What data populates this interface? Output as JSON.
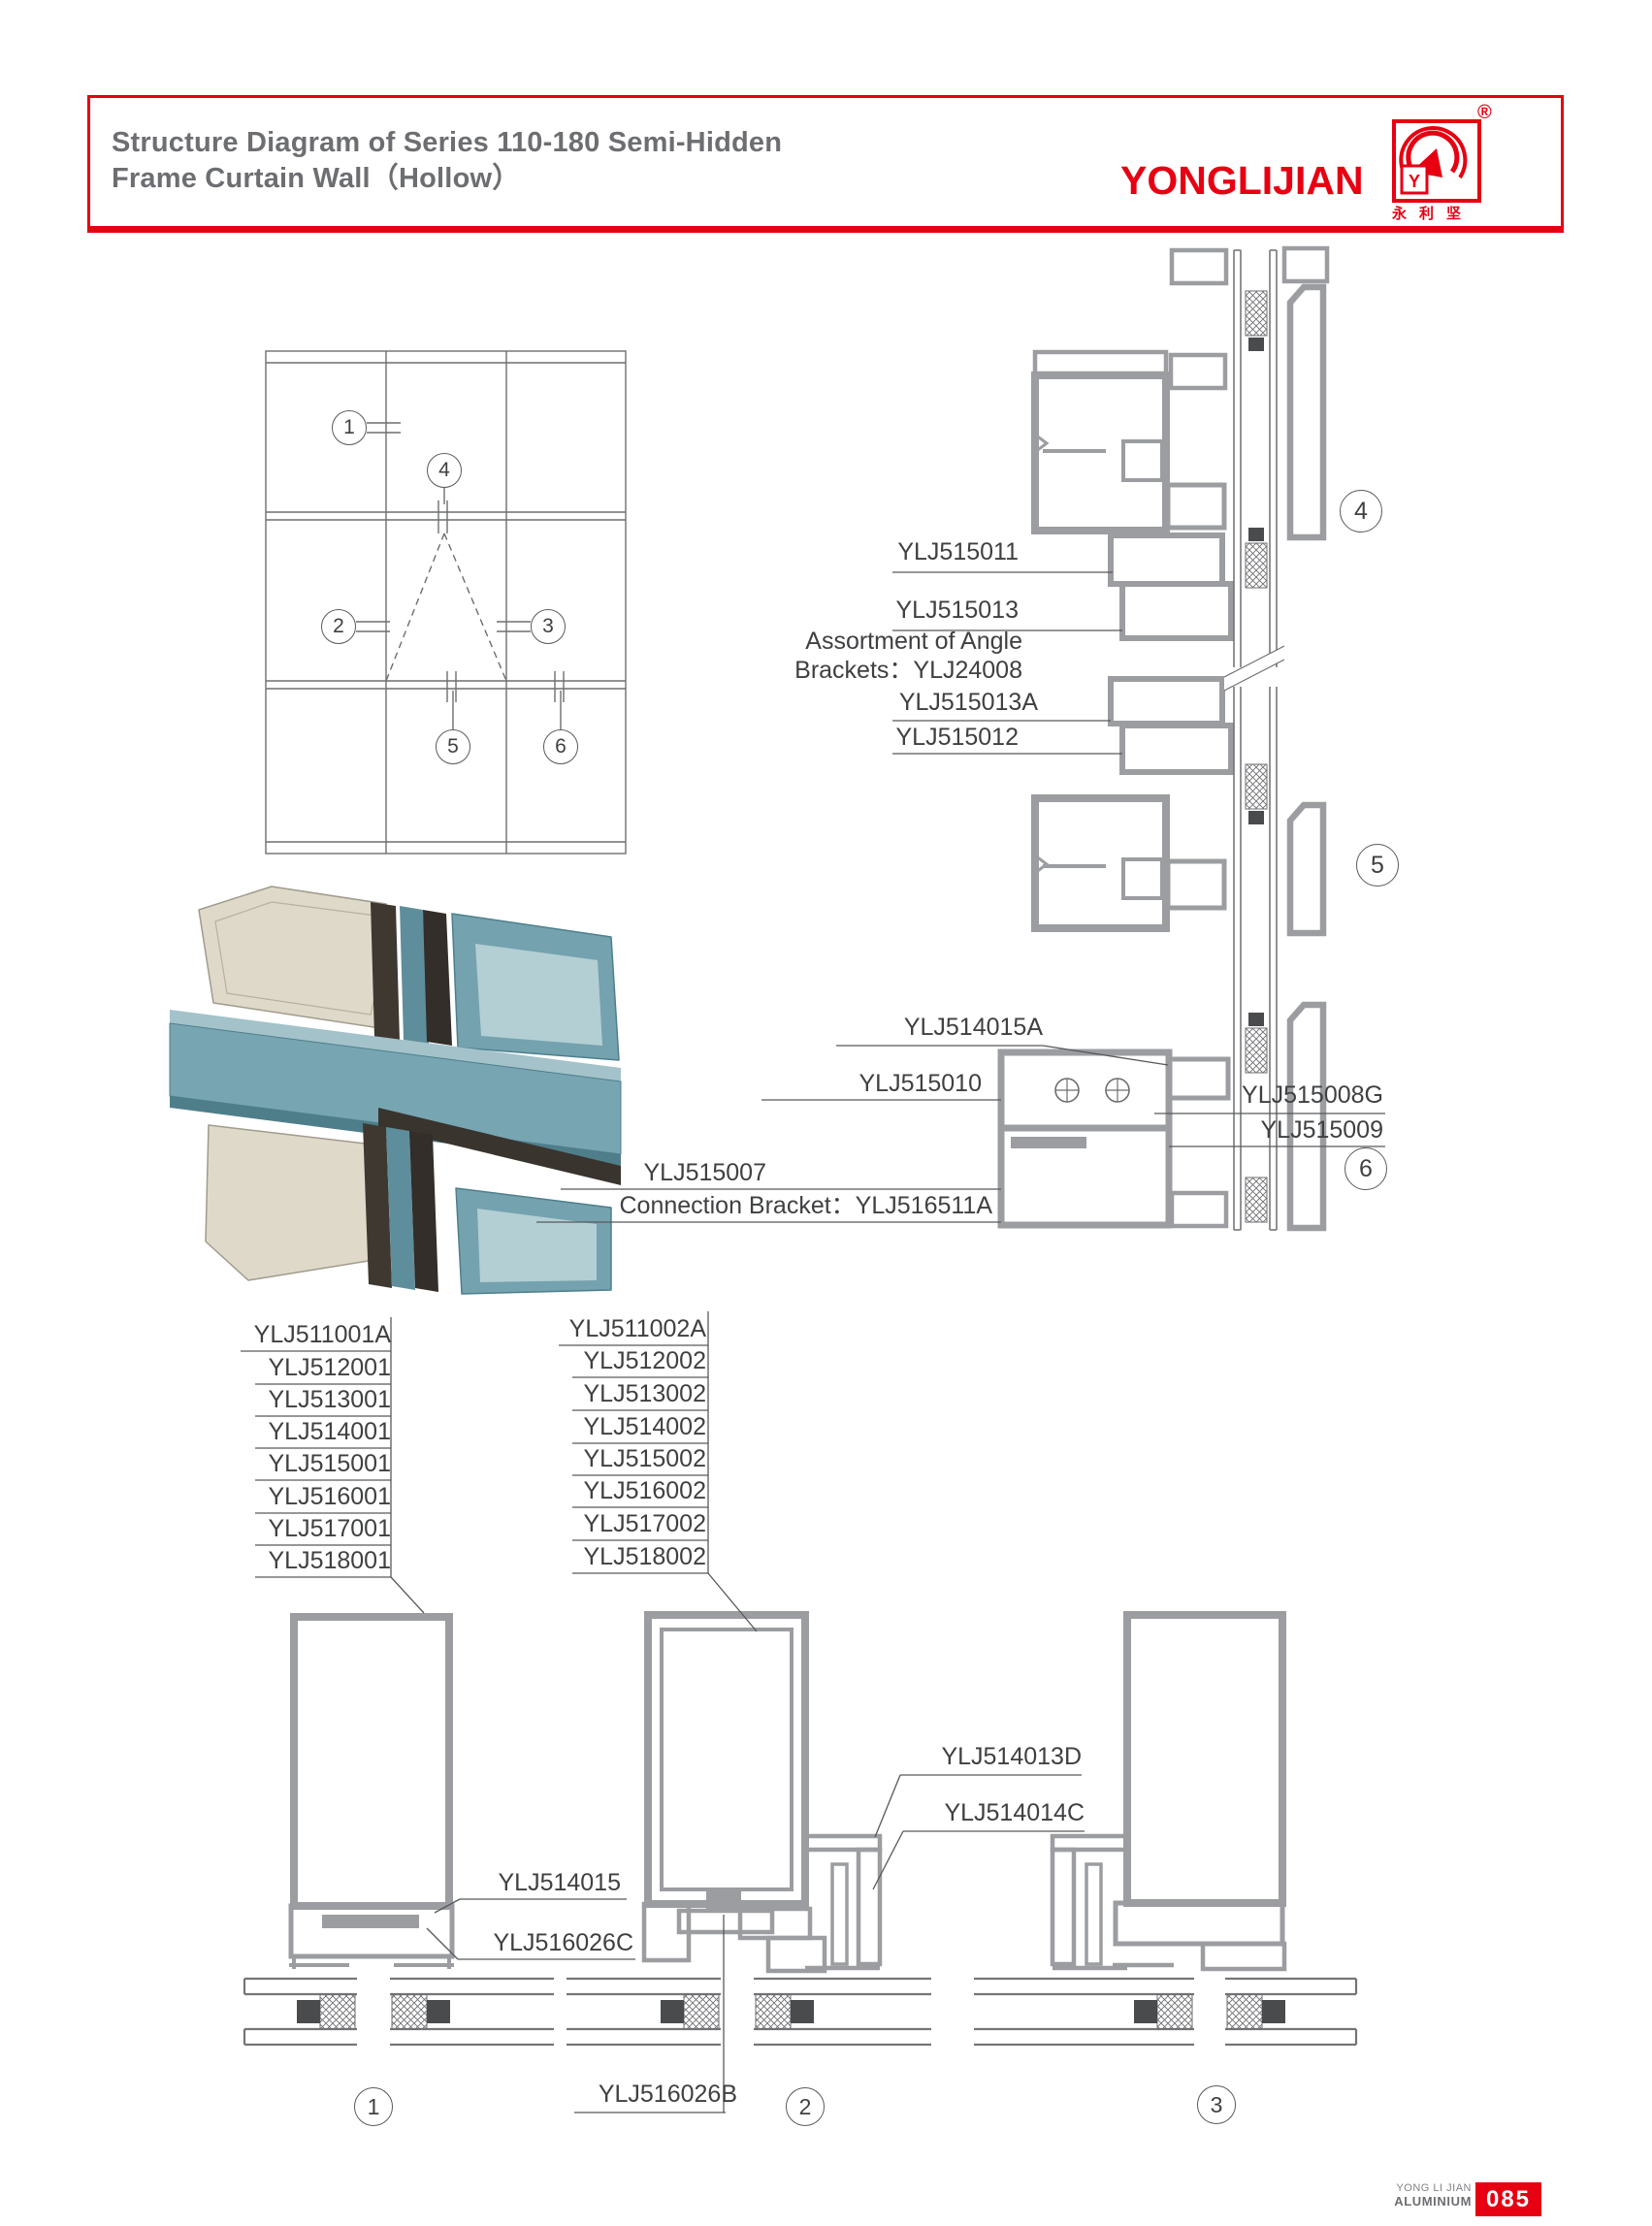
{
  "header": {
    "title_line1": "Structure Diagram of Series 110-180 Semi-Hidden",
    "title_line2": "Frame Curtain Wall（Hollow）"
  },
  "logo": {
    "brand": "YONGLIJIAN",
    "registered": "®",
    "mark_letter": "Y",
    "chinese": "永利坚",
    "accent_color": "#e60012"
  },
  "elevation": {
    "callouts": [
      "1",
      "2",
      "3",
      "4",
      "5",
      "6"
    ]
  },
  "details": {
    "callouts": [
      "4",
      "5",
      "6"
    ],
    "labels": {
      "l515011": "YLJ515011",
      "l515013": "YLJ515013",
      "angle_line1": "Assortment of Angle",
      "angle_line2": "Brackets：YLJ24008",
      "l515013a": "YLJ515013A",
      "l515012": "YLJ515012",
      "l514015a": "YLJ514015A",
      "l515010": "YLJ515010",
      "l515008g": "YLJ515008G",
      "l515009": "YLJ515009",
      "l515007": "YLJ515007",
      "connection": "Connection Bracket：YLJ516511A"
    }
  },
  "parts_left": [
    "YLJ511001A",
    "YLJ512001",
    "YLJ513001",
    "YLJ514001",
    "YLJ515001",
    "YLJ516001",
    "YLJ517001",
    "YLJ518001"
  ],
  "parts_right": [
    "YLJ511002A",
    "YLJ512002",
    "YLJ513002",
    "YLJ514002",
    "YLJ515002",
    "YLJ516002",
    "YLJ517002",
    "YLJ518002"
  ],
  "bottom": {
    "callouts": [
      "1",
      "2",
      "3"
    ],
    "labels": {
      "l514015": "YLJ514015",
      "l516026c": "YLJ516026C",
      "l514013d": "YLJ514013D",
      "l514014c": "YLJ514014C",
      "l516026b": "YLJ516026B"
    }
  },
  "footer": {
    "brand_line1": "YONG LI JIAN",
    "brand_line2": "ALUMINIUM",
    "page_number": "085"
  },
  "colors": {
    "accent_red": "#e60012",
    "title_gray": "#6d6e71",
    "profile_gray": "#9b9da0",
    "label_dark": "#3f4042"
  }
}
